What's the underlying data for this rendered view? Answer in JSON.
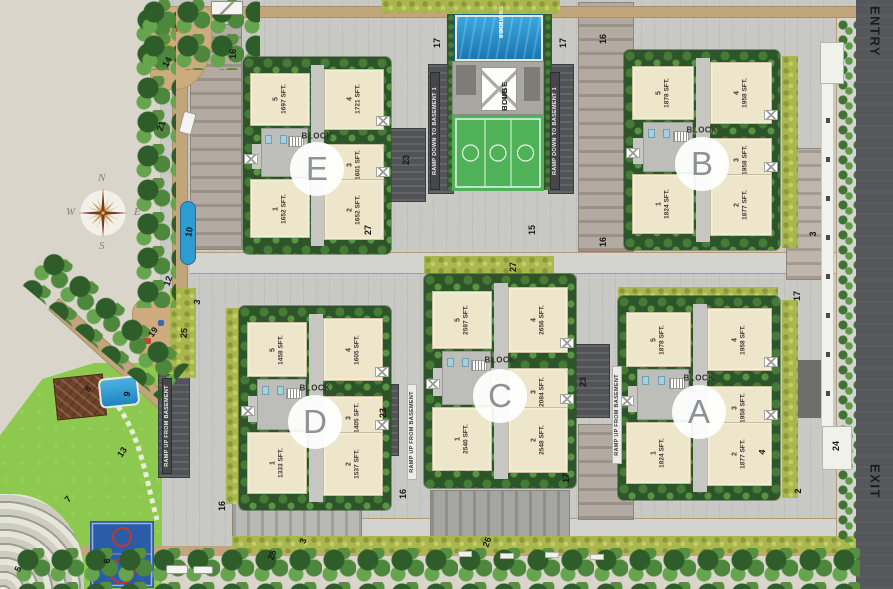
{
  "site": {
    "entry_label": "ENTRY",
    "exit_label": "EXIT"
  },
  "compass": {
    "n": "N",
    "e": "E",
    "s": "S",
    "w": "W"
  },
  "club": {
    "pool_line1": "SWIMMING",
    "pool_line2": "POOL",
    "house_line1": "CLUB",
    "house_line2": "HOUSE"
  },
  "block_word": "BLOCK",
  "colors": {
    "pool_blue": "#1f85bd",
    "lawn_green": "#8cc94e",
    "hedge_green": "#aab74e",
    "tree_green": "#4d873c",
    "unit_cream": "#eee6cb",
    "road_dark": "#55575b",
    "court_blue": "#2b5ca8",
    "court_red": "#c0392b"
  },
  "blocks": [
    {
      "letter": "E",
      "x": 243,
      "y": 57,
      "w": 148,
      "h": 197,
      "units": [
        {
          "pos": "u5",
          "no": "5",
          "area": "1697 SFT."
        },
        {
          "pos": "u4",
          "no": "4",
          "area": "1721 SFT."
        },
        {
          "pos": "u3",
          "no": "3",
          "area": "1601 SFT."
        },
        {
          "pos": "u1",
          "no": "1",
          "area": "1652 SFT."
        },
        {
          "pos": "u2",
          "no": "2",
          "area": "1652 SFT."
        }
      ]
    },
    {
      "letter": "B",
      "x": 624,
      "y": 50,
      "w": 156,
      "h": 200,
      "units": [
        {
          "pos": "u5",
          "no": "5",
          "area": "1878 SFT."
        },
        {
          "pos": "u4",
          "no": "4",
          "area": "1958 SFT."
        },
        {
          "pos": "u3",
          "no": "3",
          "area": "1958 SFT."
        },
        {
          "pos": "u1",
          "no": "1",
          "area": "1824 SFT."
        },
        {
          "pos": "u2",
          "no": "2",
          "area": "1877 SFT."
        }
      ]
    },
    {
      "letter": "C",
      "x": 424,
      "y": 274,
      "w": 152,
      "h": 214,
      "units": [
        {
          "pos": "u5",
          "no": "5",
          "area": "2587 SFT."
        },
        {
          "pos": "u4",
          "no": "4",
          "area": "2656 SFT."
        },
        {
          "pos": "u3",
          "no": "3",
          "area": "2084 SFT."
        },
        {
          "pos": "u1",
          "no": "1",
          "area": "2540 SFT."
        },
        {
          "pos": "u2",
          "no": "2",
          "area": "2548 SFT."
        }
      ]
    },
    {
      "letter": "A",
      "x": 618,
      "y": 296,
      "w": 162,
      "h": 204,
      "units": [
        {
          "pos": "u5",
          "no": "5",
          "area": "1878 SFT."
        },
        {
          "pos": "u4",
          "no": "4",
          "area": "1958 SFT."
        },
        {
          "pos": "u3",
          "no": "3",
          "area": "1958 SFT."
        },
        {
          "pos": "u1",
          "no": "1",
          "area": "1824 SFT."
        },
        {
          "pos": "u2",
          "no": "2",
          "area": "1877 SFT."
        }
      ]
    },
    {
      "letter": "D",
      "x": 239,
      "y": 306,
      "w": 152,
      "h": 204,
      "units": [
        {
          "pos": "u5",
          "no": "5",
          "area": "1458 SFT."
        },
        {
          "pos": "u4",
          "no": "4",
          "area": "1605 SFT."
        },
        {
          "pos": "u3",
          "no": "3",
          "area": "1405 SFT."
        },
        {
          "pos": "u1",
          "no": "1",
          "area": "1333 SFT."
        },
        {
          "pos": "u2",
          "no": "2",
          "area": "1537 SFT."
        }
      ]
    }
  ],
  "ramps": [
    {
      "x": 430,
      "y": 72,
      "h": 118,
      "dark": true,
      "lines": [
        "RAMP UP FROM BASEMENT 1",
        "RAMP DOWN TO BASEMENT 1"
      ]
    },
    {
      "x": 550,
      "y": 72,
      "h": 118,
      "dark": true,
      "lines": [
        "RAMP UP FROM BASEMENT 1",
        "RAMP DOWN TO BASEMENT 1"
      ]
    },
    {
      "x": 162,
      "y": 378,
      "h": 96,
      "dark": true,
      "lines": [
        "RAMP DOWN TO BASEMENT",
        "RAMP UP FROM BASEMENT"
      ]
    },
    {
      "x": 407,
      "y": 384,
      "h": 96,
      "dark": false,
      "lines": [
        "RAMP DOWN TO BASEMENT",
        "RAMP UP FROM BASEMENT"
      ]
    },
    {
      "x": 612,
      "y": 366,
      "h": 98,
      "dark": false,
      "lines": [
        "RAMP DOWN TO BASEMENT",
        "RAMP UP FROM BASEMENT"
      ]
    }
  ],
  "markers": [
    {
      "t": "17",
      "x": 437,
      "y": 43,
      "r": -90
    },
    {
      "t": "17",
      "x": 563,
      "y": 43,
      "r": -90
    },
    {
      "t": "16",
      "x": 603,
      "y": 39,
      "r": -90
    },
    {
      "t": "16",
      "x": 233,
      "y": 54,
      "r": -90
    },
    {
      "t": "14",
      "x": 167,
      "y": 62,
      "r": -62
    },
    {
      "t": "21",
      "x": 161,
      "y": 126,
      "r": -70
    },
    {
      "t": "10",
      "x": 189,
      "y": 232,
      "r": -80
    },
    {
      "t": "12",
      "x": 168,
      "y": 281,
      "r": -72
    },
    {
      "t": "3",
      "x": 197,
      "y": 302,
      "r": -80
    },
    {
      "t": "19",
      "x": 153,
      "y": 332,
      "r": -55
    },
    {
      "t": "25",
      "x": 184,
      "y": 333,
      "r": -85
    },
    {
      "t": "23",
      "x": 406,
      "y": 160,
      "r": -90
    },
    {
      "t": "27",
      "x": 368,
      "y": 230,
      "r": -90
    },
    {
      "t": "15",
      "x": 532,
      "y": 230,
      "r": -90
    },
    {
      "t": "16",
      "x": 603,
      "y": 242,
      "r": -90
    },
    {
      "t": "27",
      "x": 513,
      "y": 267,
      "r": -90
    },
    {
      "t": "23",
      "x": 583,
      "y": 382,
      "r": -90
    },
    {
      "t": "23",
      "x": 383,
      "y": 413,
      "r": -90
    },
    {
      "t": "8",
      "x": 88,
      "y": 389,
      "r": -55
    },
    {
      "t": "9",
      "x": 127,
      "y": 394,
      "r": -80
    },
    {
      "t": "13",
      "x": 122,
      "y": 452,
      "r": -55
    },
    {
      "t": "7",
      "x": 68,
      "y": 499,
      "r": -50
    },
    {
      "t": "5",
      "x": 18,
      "y": 569,
      "r": -65
    },
    {
      "t": "6",
      "x": 107,
      "y": 561,
      "r": -85
    },
    {
      "t": "16",
      "x": 222,
      "y": 506,
      "r": -90
    },
    {
      "t": "25",
      "x": 272,
      "y": 555,
      "r": -70
    },
    {
      "t": "3",
      "x": 303,
      "y": 541,
      "r": -72
    },
    {
      "t": "16",
      "x": 403,
      "y": 494,
      "r": -90
    },
    {
      "t": "17",
      "x": 566,
      "y": 478,
      "r": -90
    },
    {
      "t": "26",
      "x": 487,
      "y": 542,
      "r": -70
    },
    {
      "t": "3",
      "x": 813,
      "y": 234,
      "r": -90
    },
    {
      "t": "17",
      "x": 797,
      "y": 296,
      "r": -90
    },
    {
      "t": "24",
      "x": 836,
      "y": 446,
      "r": -90
    },
    {
      "t": "2",
      "x": 798,
      "y": 491,
      "r": -90
    },
    {
      "t": "4",
      "x": 762,
      "y": 452,
      "r": -80
    }
  ]
}
